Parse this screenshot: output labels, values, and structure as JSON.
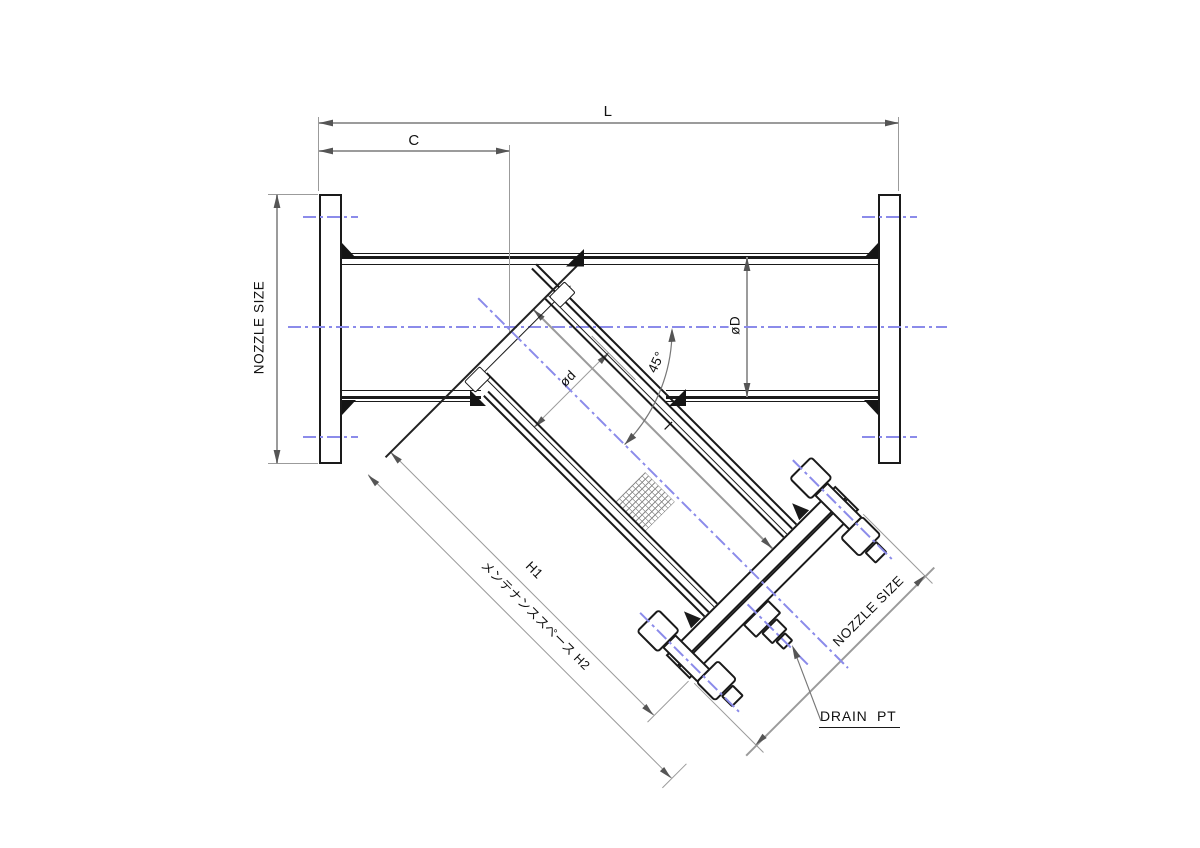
{
  "drawing_type": "Y-strainer outline dimensional drawing",
  "labels": {
    "overall_length": "L",
    "inlet_to_branch": "C",
    "nozzle_size_main": "NOZZLE SIZE",
    "body_diameter": "øD",
    "screen_diameter": "ød",
    "branch_angle": "45°",
    "screen_length": "l",
    "height": "H1",
    "maintenance_space": "メンテナンススペース H2",
    "nozzle_size_branch": "NOZZLE SIZE",
    "drain": "DRAIN  PT"
  },
  "colors": {
    "line": "#1a1a1a",
    "dimension": "#9b9b9b",
    "arrow": "#555555",
    "centerline": "#8b8bea",
    "background": "#ffffff",
    "text": "#111111"
  }
}
